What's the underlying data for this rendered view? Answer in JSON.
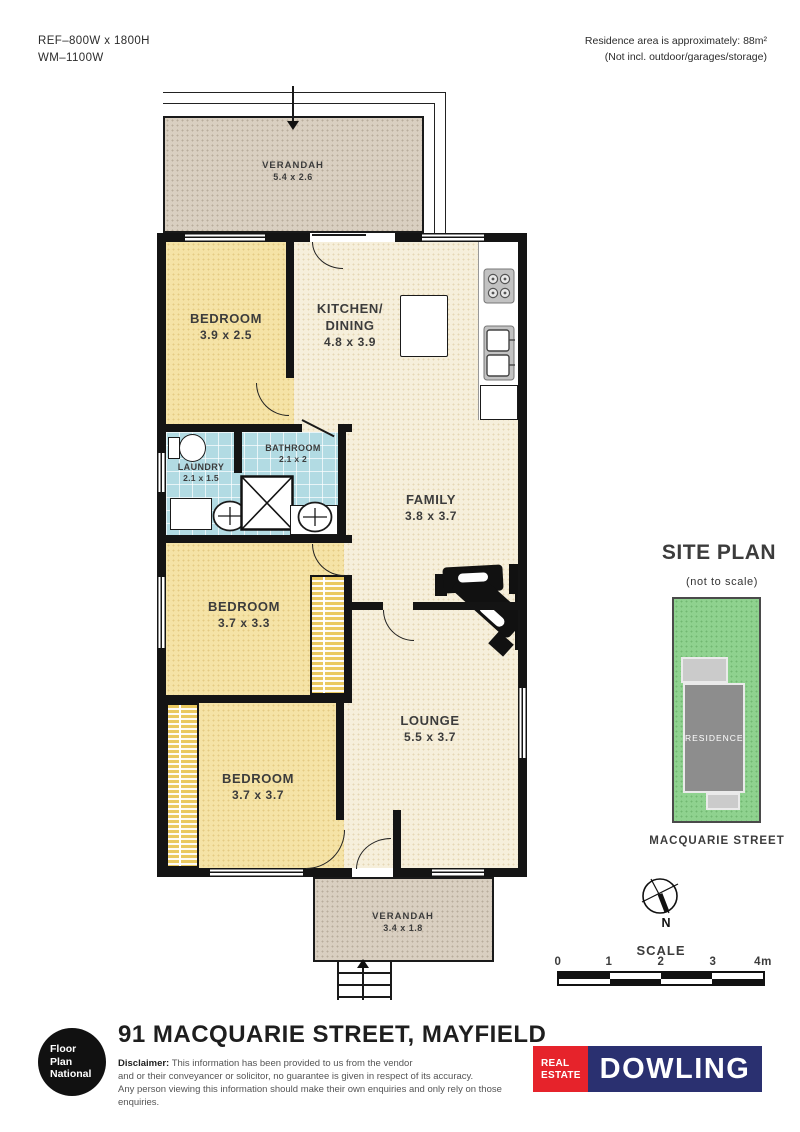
{
  "header": {
    "ref_line1": "REF–800W x 1800H",
    "ref_line2": "WM–1100W",
    "area_line1": "Residence area is approximately: 88m²",
    "area_line2": "(Not incl. outdoor/garages/storage)"
  },
  "plan": {
    "rooms": {
      "verandah_top": {
        "name": "VERANDAH",
        "dims": "5.4 x 2.6"
      },
      "bedroom1": {
        "name": "BEDROOM",
        "dims": "3.9 x 2.5"
      },
      "kitchen": {
        "name_line1": "KITCHEN/",
        "name_line2": "DINING",
        "dims": "4.8 x 3.9"
      },
      "bathroom": {
        "name": "BATHROOM",
        "dims": "2.1 x 2"
      },
      "laundry": {
        "name": "LAUNDRY",
        "dims": "2.1 x 1.5"
      },
      "family": {
        "name": "FAMILY",
        "dims": "3.8 x 3.7"
      },
      "bedroom2": {
        "name": "BEDROOM",
        "dims": "3.7 x 3.3"
      },
      "lounge": {
        "name": "LOUNGE",
        "dims": "5.5 x 3.7"
      },
      "bedroom3": {
        "name": "BEDROOM",
        "dims": "3.7 x 3.7"
      },
      "verandah_bottom": {
        "name": "VERANDAH",
        "dims": "3.4 x 1.8"
      }
    }
  },
  "site_plan": {
    "title": "SITE PLAN",
    "subtitle": "(not to scale)",
    "residence_label": "RESIDENCE",
    "street_label": "MACQUARIE STREET"
  },
  "compass": {
    "north_label": "N"
  },
  "scale_bar": {
    "label": "SCALE",
    "ticks": [
      "0",
      "1",
      "2",
      "3",
      "4m"
    ]
  },
  "footer": {
    "logo_line1": "Floor",
    "logo_line2": "Plan",
    "logo_line3": "National",
    "title": "91 MACQUARIE STREET, MAYFIELD",
    "disclaimer_label": "Disclaimer:",
    "disclaimer_line1": "This information has been provided to us from the vendor",
    "disclaimer_line2": "and or their conveyancer or solicitor, no guarantee is given in respect of its accuracy.",
    "disclaimer_line3": "Any person viewing this information should make their own enquiries and only rely on those enquiries.",
    "agency_real": "REAL",
    "agency_estate": "ESTATE",
    "agency_name": "DOWLING"
  },
  "colors": {
    "wall": "#141414",
    "cream": "#f6efdb",
    "yellow": "#f5e3a6",
    "bath-blue": "#b2dbe3",
    "beige": "#d9cfc1",
    "wardrobe": "#eac95f",
    "site-green": "#8fd28f",
    "residence-gray": "#8d8d8d",
    "verandah-gray": "#cbcbcb",
    "brand-red": "#e6232b",
    "brand-navy": "#2a3070",
    "label-ink": "#3c3c3c"
  }
}
